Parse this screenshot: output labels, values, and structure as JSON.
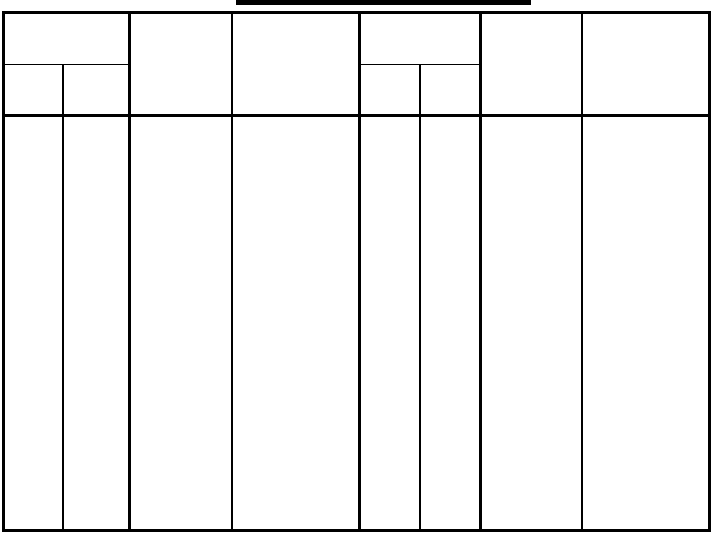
{
  "document": {
    "background_color": "#ffffff",
    "line_color": "#000000"
  },
  "title": {
    "text": "",
    "underline_color": "#000000"
  },
  "table": {
    "column_groups": [
      {
        "id": "group-1",
        "header": "",
        "subheaders": [
          "",
          ""
        ]
      },
      {
        "id": "column-2",
        "header": ""
      },
      {
        "id": "column-3",
        "header": ""
      },
      {
        "id": "group-4",
        "header": "",
        "subheaders": [
          "",
          ""
        ]
      },
      {
        "id": "column-5",
        "header": ""
      },
      {
        "id": "column-6",
        "header": ""
      }
    ],
    "body_row": {
      "cells": [
        "",
        "",
        "",
        "",
        "",
        "",
        "",
        ""
      ]
    }
  }
}
